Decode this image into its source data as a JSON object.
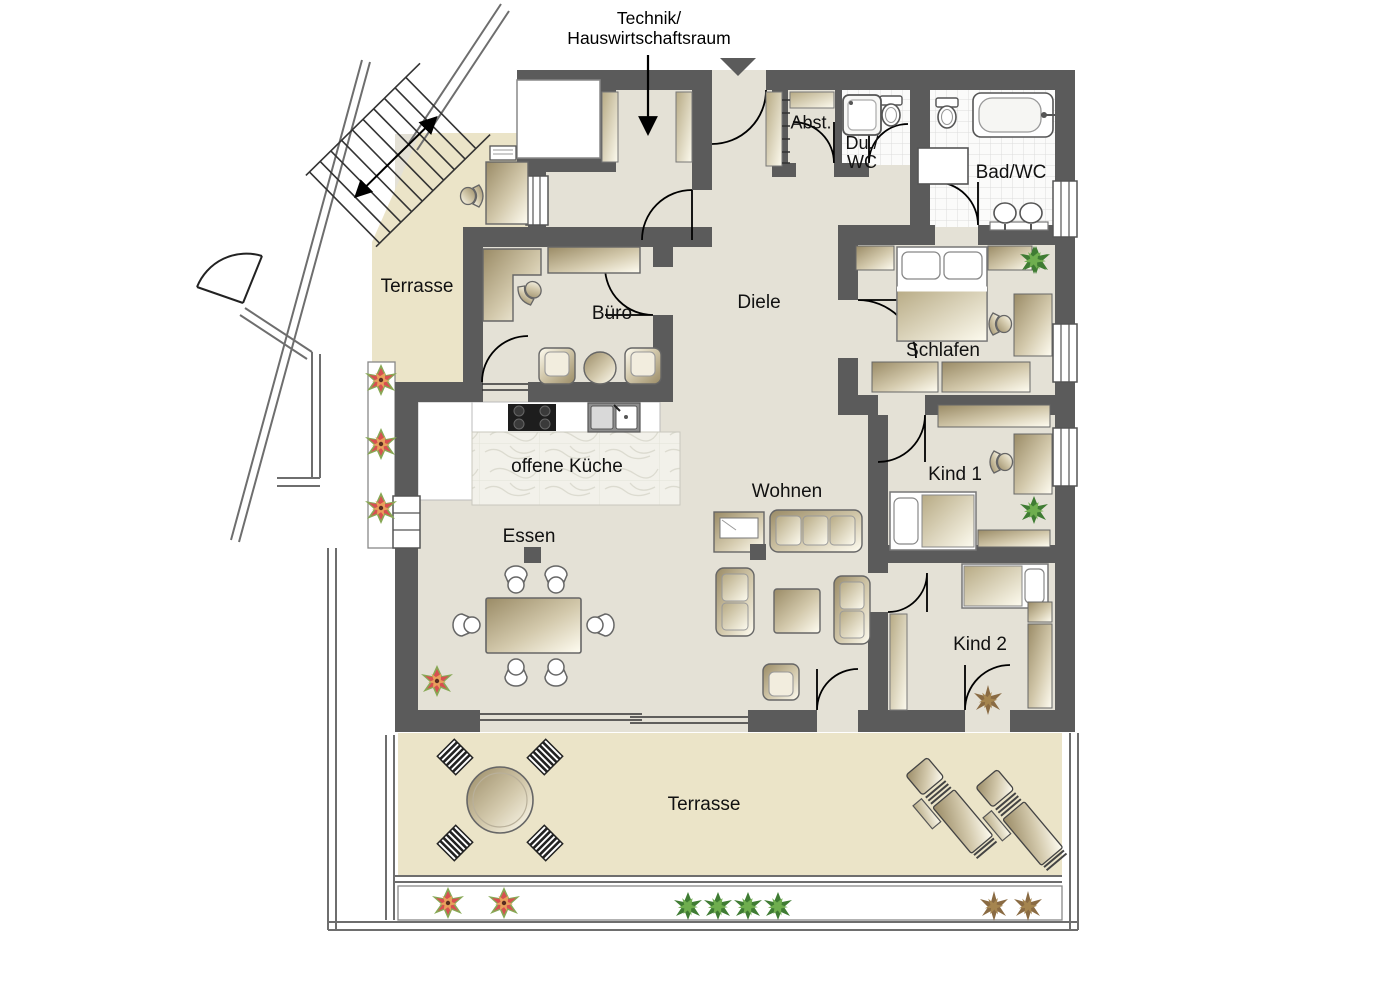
{
  "annotation": {
    "line1": "Technik/",
    "line2": "Hauswirtschaftsraum"
  },
  "rooms": {
    "abstellraum": {
      "label": "Abst."
    },
    "du_wc": {
      "line1": "Du./",
      "line2": "WC"
    },
    "bad_wc": {
      "label": "Bad/WC"
    },
    "terrasse_links": {
      "label": "Terrasse"
    },
    "buero": {
      "label": "Büro"
    },
    "diele": {
      "label": "Diele"
    },
    "schlafen": {
      "label": "Schlafen"
    },
    "offene_kueche": {
      "label": "offene Küche"
    },
    "wohnen": {
      "label": "Wohnen"
    },
    "essen": {
      "label": "Essen"
    },
    "kind_1": {
      "label": "Kind 1"
    },
    "kind_2": {
      "label": "Kind 2"
    },
    "terrasse_unten": {
      "label": "Terrasse"
    }
  },
  "icons": {
    "entrance_marker": "triangle-down",
    "stairs": "exterior-staircase-with-direction-arrow",
    "bathroom": [
      "bathtub",
      "toilet",
      "double-sink",
      "shower",
      "washing-machine"
    ],
    "kitchen": [
      "cooktop",
      "sink"
    ],
    "furniture": [
      "double-bed",
      "single-bed",
      "sofa",
      "armchair",
      "tv",
      "coffee-table",
      "dining-table",
      "desk",
      "office-chair",
      "wardrobe",
      "sideboard",
      "round-garden-table",
      "garden-chair",
      "sun-lounger"
    ],
    "plants": [
      "red-flower",
      "green-plant",
      "dried-plant"
    ]
  },
  "colors": {
    "wall": "#5b5b5b",
    "floor": "#e4e1d6",
    "terrace": "#ebe4c8",
    "furniture": "#cfc5a8",
    "tile": "#fbfbfa",
    "plant_green": "#4e8f3a",
    "flower_red": "#d85050",
    "dried_brown": "#8a6b43"
  }
}
